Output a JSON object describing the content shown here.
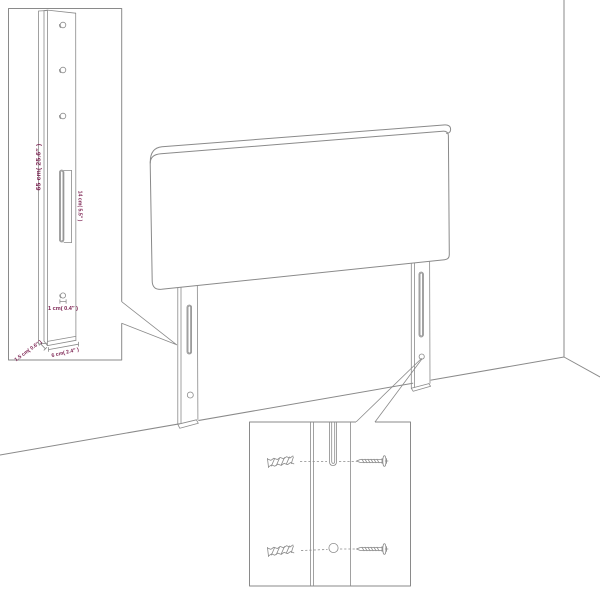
{
  "colors": {
    "line": "#8a8a8a",
    "dim-text": "#7a1f4f",
    "bg": "#ffffff"
  },
  "leg_detail": {
    "height_label": "65 cm( 25.6″ )",
    "slot_label": "14 cm( 5.5″ )",
    "hole_label": "1 cm( 0.4″ )",
    "depth_label": "1.5 cm( 0.6″ )",
    "width_label": "6 cm( 2.4″ )",
    "hole_count": 3
  },
  "mounting_detail": {
    "hardware": [
      "wall-plug-icon",
      "screw-icon"
    ],
    "rows": 2
  }
}
